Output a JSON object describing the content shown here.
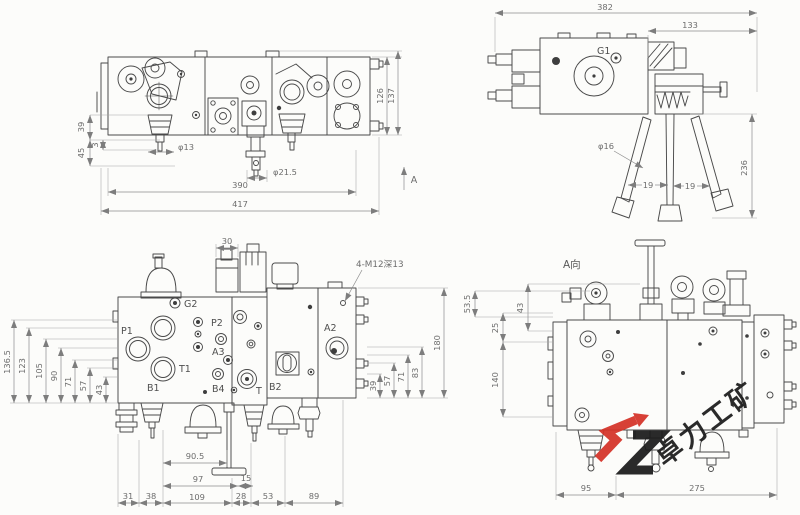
{
  "drawing": {
    "type": "hydraulic-valve-assembly-drawing",
    "line_color": "#4a4a4a",
    "paper_color": "#fcfcfa"
  },
  "front_view": {
    "arrow_label": "A",
    "dims": {
      "h39": "39",
      "h45": "45",
      "h3": "3",
      "dia13": "φ13",
      "dia21_5": "φ21.5",
      "w390": "390",
      "w417": "417",
      "h126": "126",
      "h137": "137"
    }
  },
  "side_view": {
    "port_g1": "G1",
    "dims": {
      "w382": "382",
      "w133": "133",
      "dia16": "φ16",
      "a19_left": "19",
      "a19_right": "19",
      "h236": "236"
    }
  },
  "rear_view": {
    "note": "4-M12深13",
    "dims_top": {
      "w30": "30"
    },
    "dims_left": {
      "h136_5": "136.5",
      "h123": "123",
      "h105": "105",
      "h90": "90",
      "h71": "71",
      "h57": "57",
      "h43": "43"
    },
    "dims_right": {
      "h39": "39",
      "h57": "57",
      "h71": "71",
      "h83": "83",
      "h180": "180"
    },
    "dims_bottom": {
      "w90_5": "90.5",
      "w97": "97",
      "w15": "15",
      "w31": "31",
      "w38": "38",
      "w109": "109",
      "w28": "28",
      "w53": "53",
      "w89": "89"
    },
    "ports": {
      "g2": "G2",
      "p1": "P1",
      "p2": "P2",
      "a3": "A3",
      "t1": "T1",
      "b1": "B1",
      "b4": "B4",
      "t": "T",
      "b2": "B2",
      "a2": "A2"
    }
  },
  "a_view": {
    "label": "A向",
    "dims": {
      "h53_5": "53.5",
      "h43": "43",
      "h25": "25",
      "h140": "140",
      "w95": "95",
      "w275": "275"
    }
  },
  "watermark": {
    "text": "卓力工矿",
    "red": "#d53228",
    "black": "#1b1b1b"
  }
}
